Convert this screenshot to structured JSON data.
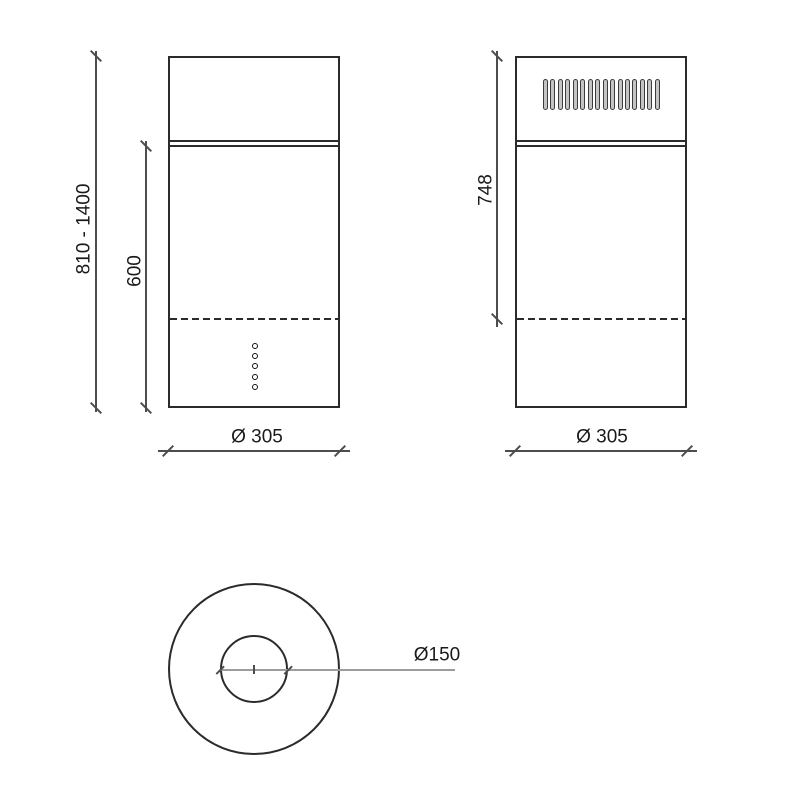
{
  "views": {
    "front": {
      "total_height_label": "810 - 1400",
      "body_height_label": "600",
      "width_label": "Ø 305",
      "control_button_count": 5
    },
    "side": {
      "upper_height_label": "748",
      "width_label": "Ø 305",
      "grille_slot_count": 16
    },
    "top": {
      "duct_diameter_label": "Ø150"
    }
  },
  "colors": {
    "background": "#ffffff",
    "outline": "#2b2b2b",
    "dimension": "#4d4d4d",
    "duct_line": "#9c9c9c",
    "grille_fill": "#c4c4c4",
    "text": "#1a1a1a"
  }
}
